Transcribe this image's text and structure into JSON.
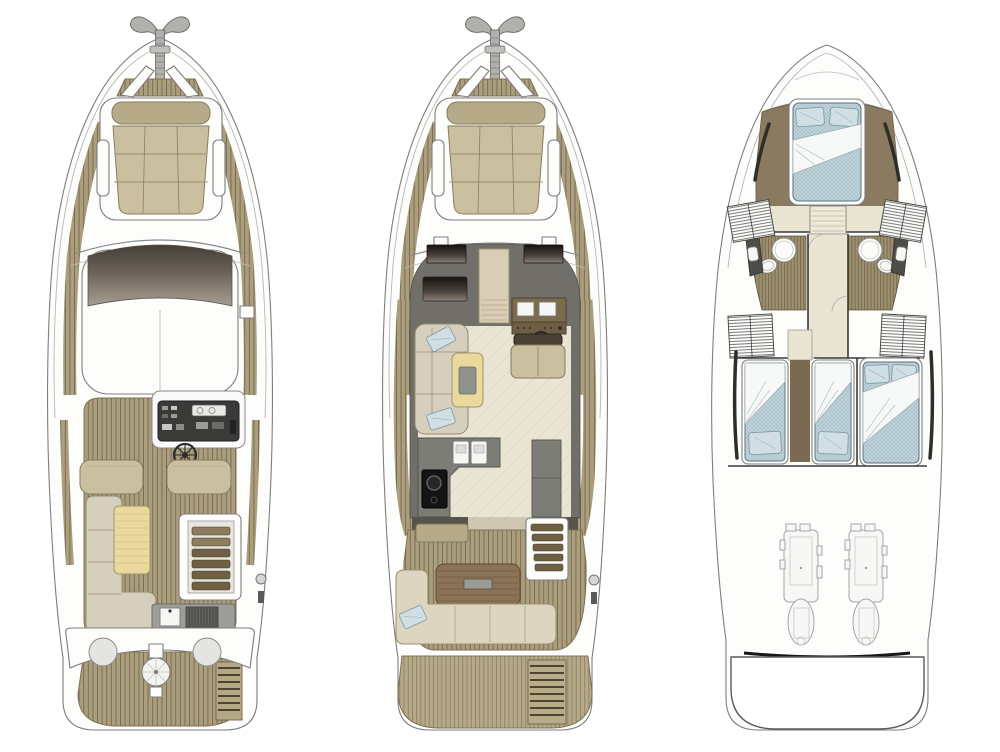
{
  "views": [
    {
      "name": "flybridge-deck-plan",
      "position": "left"
    },
    {
      "name": "main-deck-plan",
      "position": "center"
    },
    {
      "name": "lower-deck-plan",
      "position": "right"
    }
  ],
  "colors": {
    "background": "#ffffff",
    "hullStroke": "#7e7e7e",
    "railStroke": "#b7b7b7",
    "teak": "#ab9e7d",
    "teakLine": "#6d6148",
    "teakLight": "#b5a987",
    "teakLightLine": "#847659",
    "cushion": "#cabf9f",
    "cushionDark": "#b7aa89",
    "sofa": "#d7cfbd",
    "tableWood": "#e9d99c",
    "windshieldTop": "#453e37",
    "windshieldBottom": "#a79d92",
    "cabinGrey": "#706f69",
    "counterGrey": "#7d7d77",
    "floorBeige": "#eae4d3",
    "cockpitTable": "#8d7356",
    "mattress": "#bdd2d9",
    "mattressLine": "#9fb8c2",
    "pillow": "#cfdfe4",
    "bedFrame": "#5a737e",
    "woodFloor": "#9c8f6e",
    "woodFloorLine": "#6b5f44",
    "brownTrim": "#8a7a5f",
    "engineLine": "#a5a5a5",
    "stepBrown": "#6f5f43",
    "wetbarGrey": "#9d9d99",
    "screenTop": "#171310",
    "screenBottom": "#8d8178",
    "transom": "#161616"
  }
}
